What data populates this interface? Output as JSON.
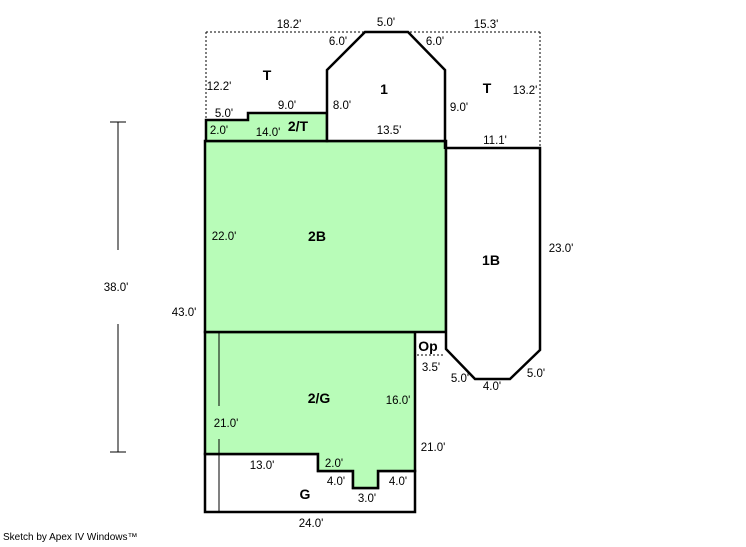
{
  "footer": {
    "credit": "Sketch by Apex IV Windows™"
  },
  "colors": {
    "area_fill_green": "#b8fcb8",
    "area_fill_white": "#ffffff",
    "line": "#000000",
    "background": "#ffffff"
  },
  "areas": {
    "t_left": "T",
    "one": "1",
    "t_right": "T",
    "two_t": "2/T",
    "two_b": "2B",
    "one_b": "1B",
    "op": "Op",
    "two_g": "2/G",
    "g": "G"
  },
  "dimensions": [
    "18.2'",
    "5.0'",
    "15.3'",
    "6.0'",
    "6.0'",
    "12.2'",
    "13.2'",
    "9.0'",
    "8.0'",
    "9.0'",
    "5.0'",
    "2.0'",
    "14.0'",
    "13.5'",
    "11.1'",
    "22.0'",
    "23.0'",
    "38.0'",
    "43.0'",
    "3.5'",
    "5.0'",
    "4.0'",
    "5.0'",
    "16.0'",
    "21.0'",
    "21.0'",
    "13.0'",
    "2.0'",
    "4.0'",
    "3.0'",
    "4.0'",
    "24.0'"
  ]
}
